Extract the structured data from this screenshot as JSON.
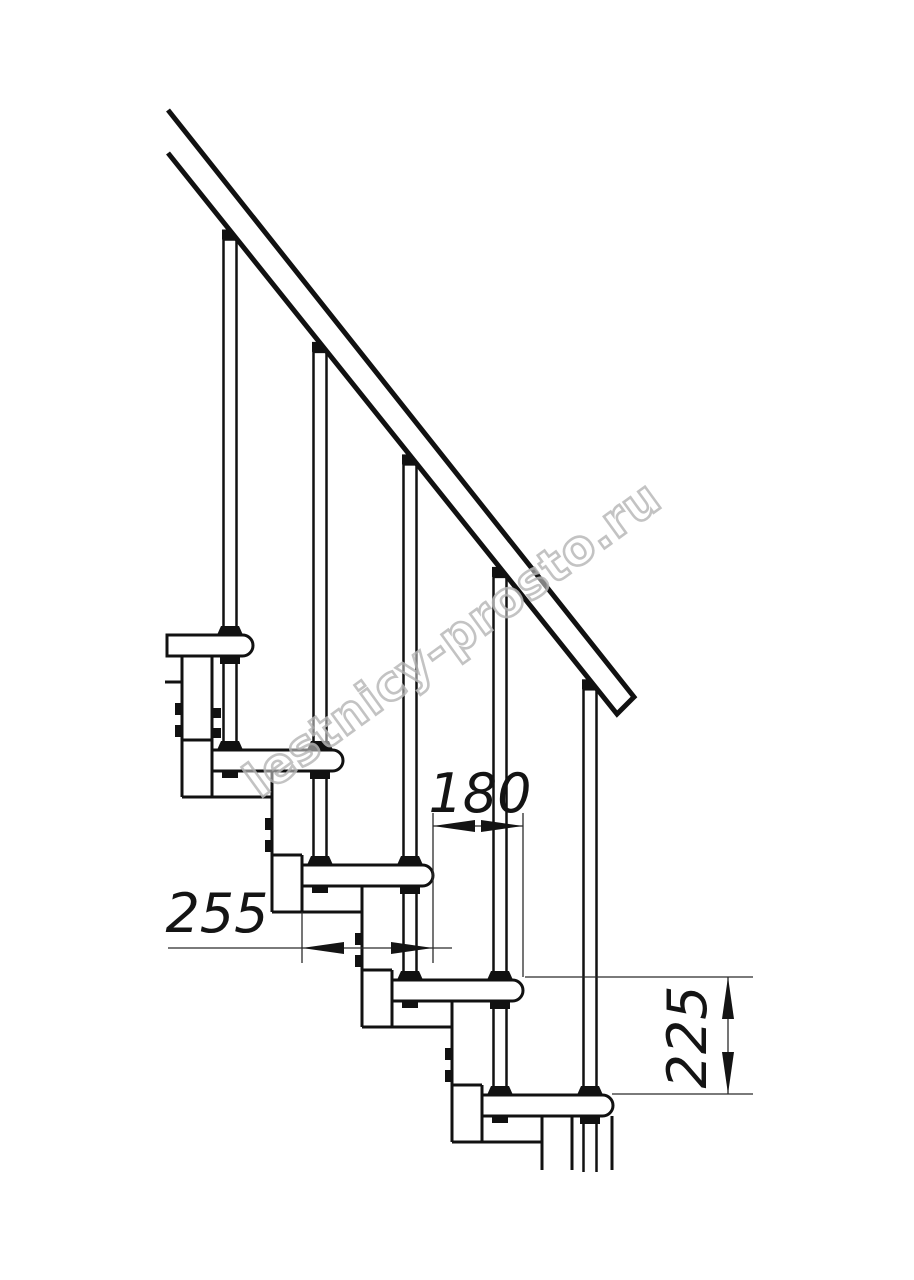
{
  "drawing": {
    "title": "staircase-side-elevation"
  },
  "dimensions": {
    "run": {
      "label": "180"
    },
    "depth": {
      "label": "255"
    },
    "rise": {
      "label": "225"
    }
  },
  "watermark": {
    "text": "lestnicy-prosto.ru"
  },
  "colors": {
    "line": "#111111",
    "dimension_line": "#2b2b2b",
    "watermark_outline": "#b9b9b9",
    "background": "#ffffff"
  }
}
